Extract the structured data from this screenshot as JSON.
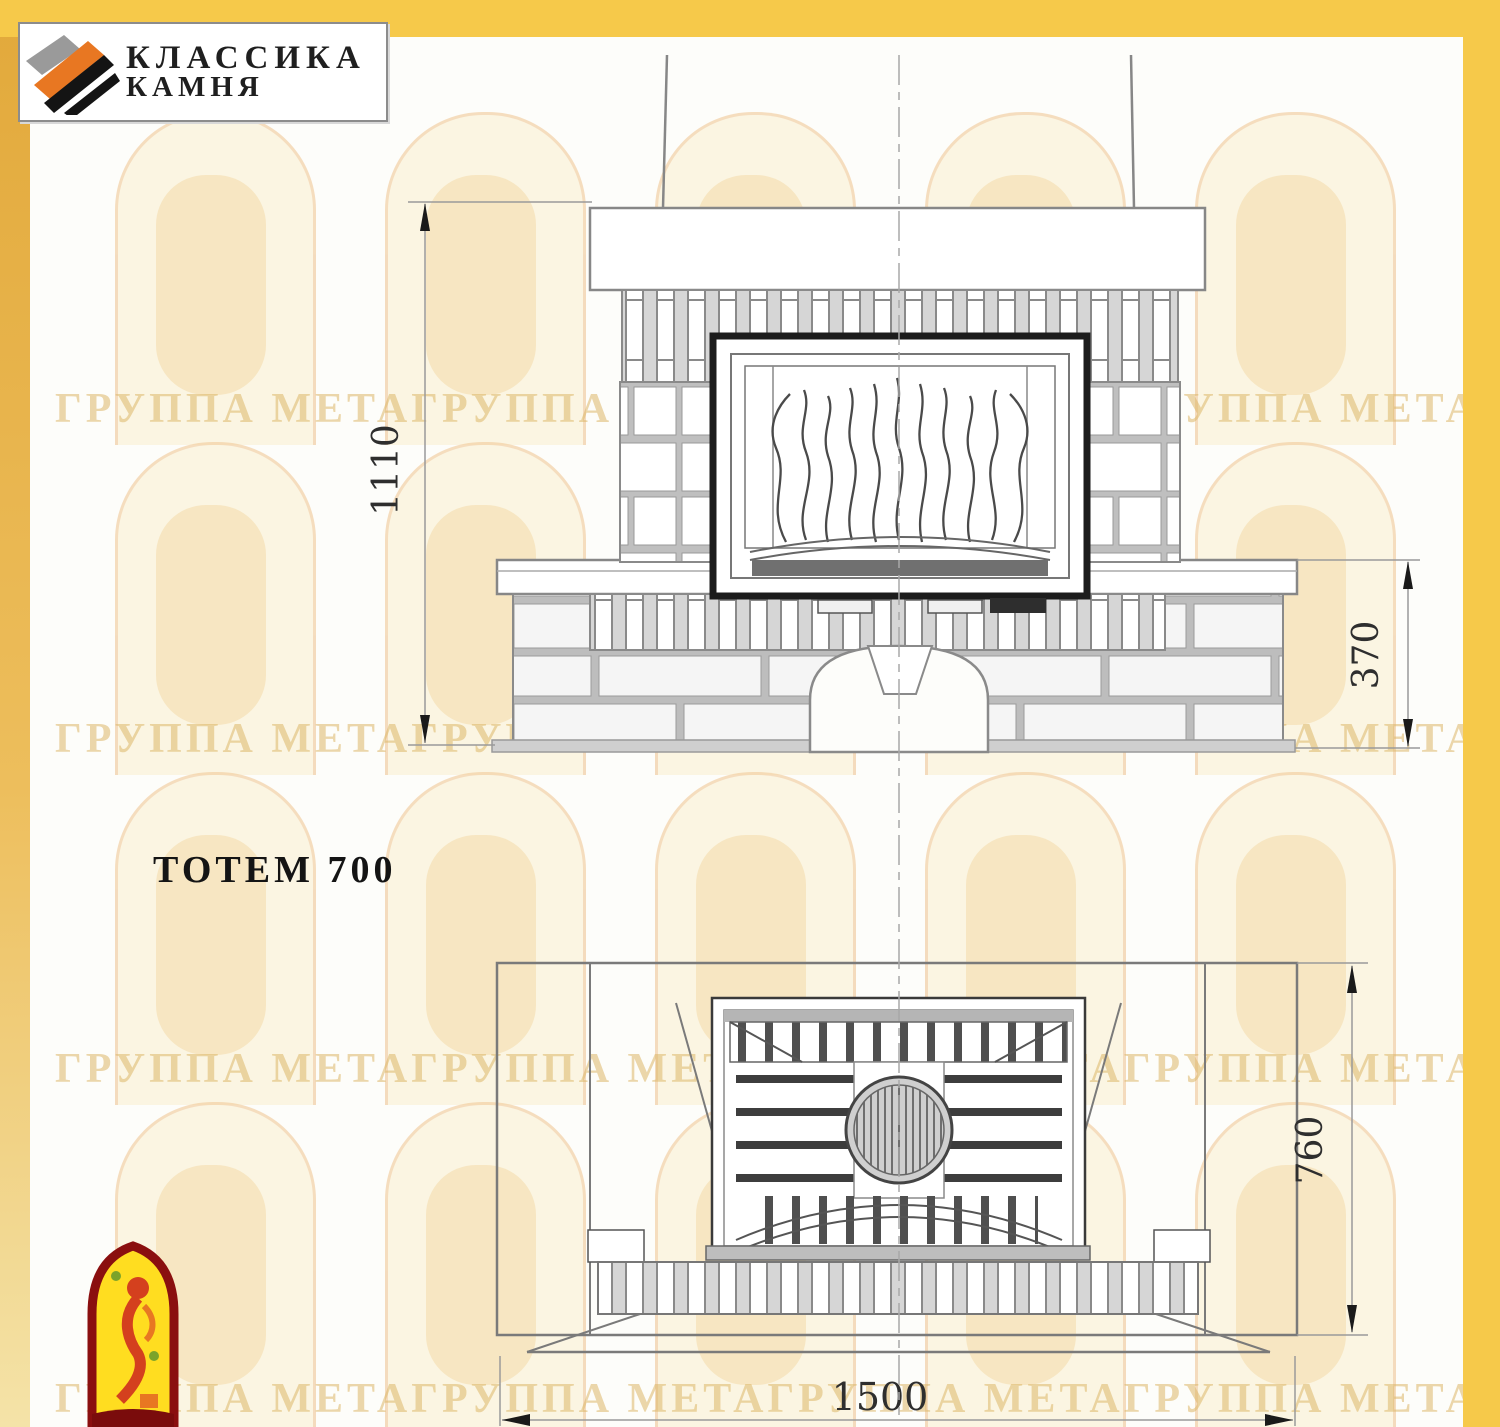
{
  "page": {
    "background": "#fdfdfa",
    "accent_yellow": "#F6C94A"
  },
  "header_logo": {
    "line1": "КЛАССИКА",
    "line2": "КАМНЯ"
  },
  "watermark": {
    "text": "ГРУППА МЕТАГРУППА МЕТАГРУППА МЕТАГРУППА МЕТАГРУППА МЕТА"
  },
  "model": {
    "title": "ТОТЕМ 700"
  },
  "dimensions": {
    "front_total_height": "1110",
    "front_base_height": "370",
    "plan_depth": "760",
    "plan_width": "1500"
  }
}
